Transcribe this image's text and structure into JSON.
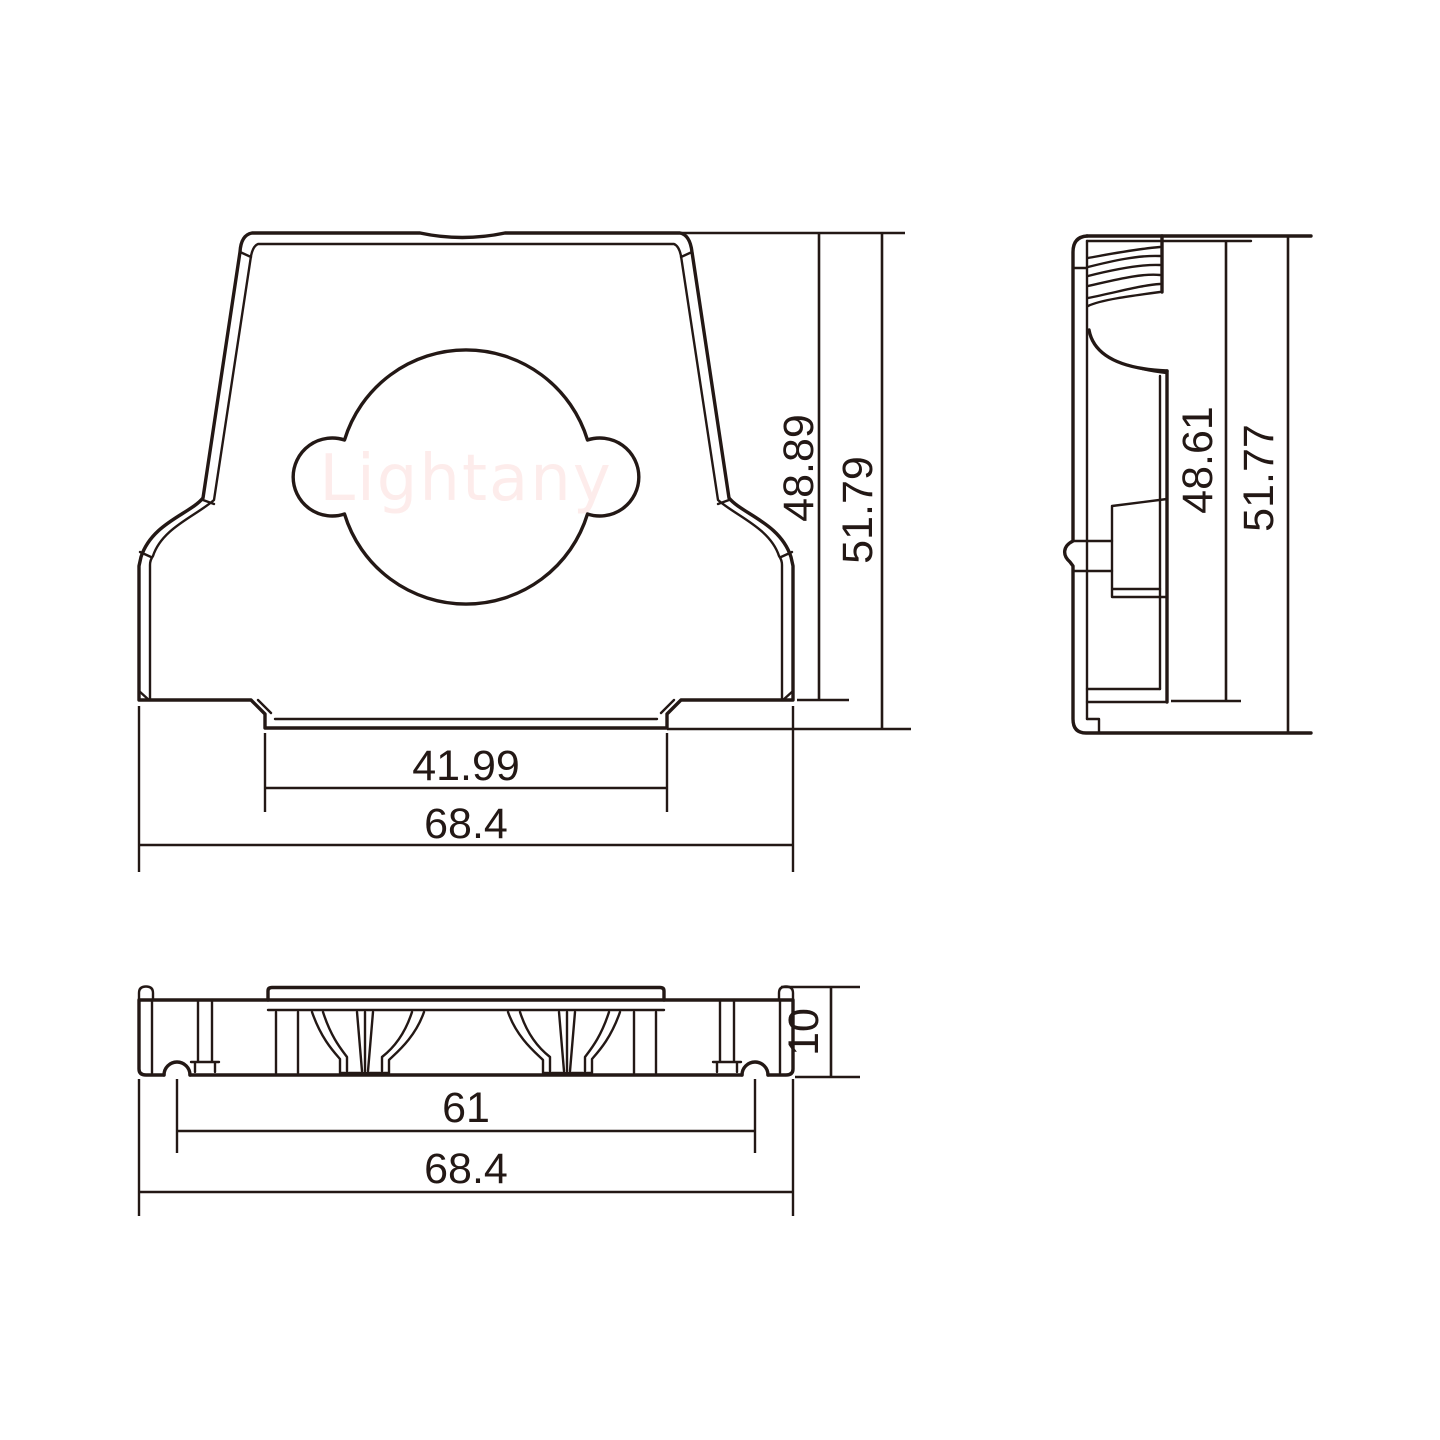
{
  "watermark": {
    "text": "Lightany",
    "color": "#fdeceb"
  },
  "drawing": {
    "line_color": "#231815",
    "background_color": "#ffffff"
  },
  "views": {
    "front": {
      "label": "front-view-of-backshell",
      "dimensions": {
        "inner_width": "41.99",
        "outer_width": "68.4",
        "inner_height": "48.89",
        "outer_height": "51.79"
      }
    },
    "side": {
      "label": "side-view-of-backshell",
      "dimensions": {
        "inner_height": "48.61",
        "outer_height": "51.77"
      }
    },
    "bottom": {
      "label": "bottom-view-of-backshell",
      "dimensions": {
        "inner_width": "61",
        "outer_width": "68.4",
        "height": "10"
      }
    }
  }
}
